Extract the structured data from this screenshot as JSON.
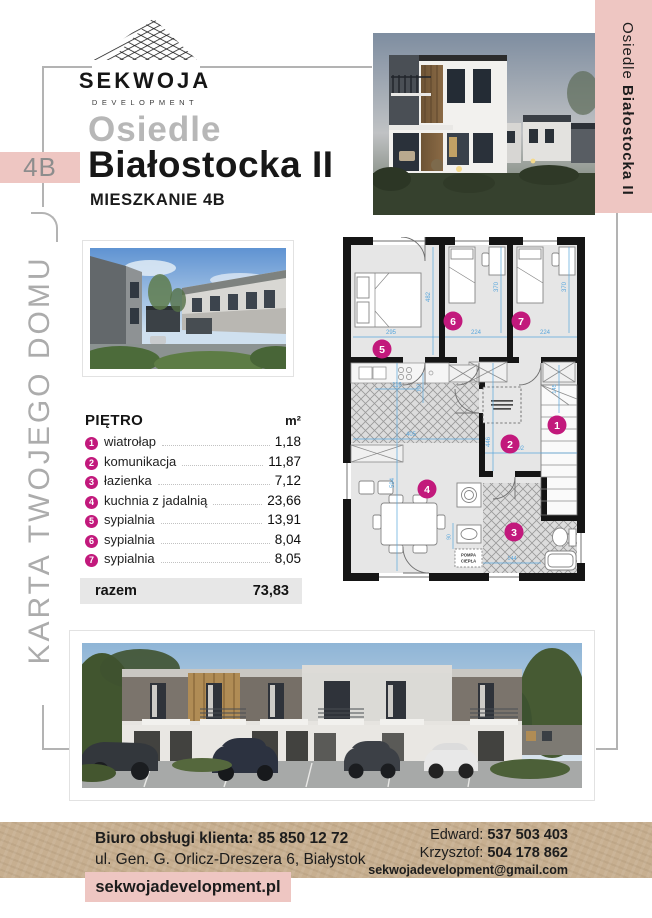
{
  "brand": {
    "name": "SEKWOJA",
    "subtitle": "DEVELOPMENT"
  },
  "header": {
    "unit_badge": "4B",
    "estate_label": "Osiedle",
    "estate_name": "Białostocka II",
    "unit_label": "MIESZKANIE 4B"
  },
  "side_banners": {
    "left": "KARTA TWOJEGO DOMU",
    "right_regular": "Osiedle ",
    "right_bold": "Białostocka II"
  },
  "area_table": {
    "header_label": "PIĘTRO",
    "header_unit": "m²",
    "rows": [
      {
        "num": "1",
        "label": "wiatrołap",
        "value": "1,18"
      },
      {
        "num": "2",
        "label": "komunikacja",
        "value": "11,87"
      },
      {
        "num": "3",
        "label": "łazienka",
        "value": "7,12"
      },
      {
        "num": "4",
        "label": "kuchnia z jadalnią",
        "value": "23,66"
      },
      {
        "num": "5",
        "label": "sypialnia",
        "value": "13,91"
      },
      {
        "num": "6",
        "label": "sypialnia",
        "value": "8,04"
      },
      {
        "num": "7",
        "label": "sypialnia",
        "value": "8,05"
      }
    ],
    "total_label": "razem",
    "total_value": "73,83"
  },
  "floor_plan": {
    "rooms": [
      {
        "id": "1"
      },
      {
        "id": "2"
      },
      {
        "id": "3"
      },
      {
        "id": "4"
      },
      {
        "id": "5"
      },
      {
        "id": "6"
      },
      {
        "id": "7"
      }
    ],
    "dims": {
      "w295": "295",
      "h482": "482",
      "w224a": "224",
      "h370a": "370",
      "w224b": "224",
      "h370b": "370",
      "w116": "116",
      "h100": "100",
      "h145": "145",
      "h446": "446",
      "w202": "202",
      "h594": "594",
      "w405": "405",
      "w144": "144",
      "h90": "90"
    },
    "pump_line1": "POMPA",
    "pump_line2": "CIEPŁA"
  },
  "footer": {
    "office_line": "Biuro obsługi klienta: 85 850 12 72",
    "address_line": "ul. Gen. G. Orlicz-Dreszera 6, Białystok",
    "website": "sekwojadevelopment.pl",
    "contact1_name": "Edward: ",
    "contact1_phone": "537 503 403",
    "contact2_name": "Krzysztof: ",
    "contact2_phone": "504 178 862",
    "email": "sekwojadevelopment@gmail.com"
  },
  "colors": {
    "pink": "#eec6c2",
    "magenta": "#c2197c",
    "kraft": "#c7af90",
    "dim_blue": "#58a6dc"
  }
}
